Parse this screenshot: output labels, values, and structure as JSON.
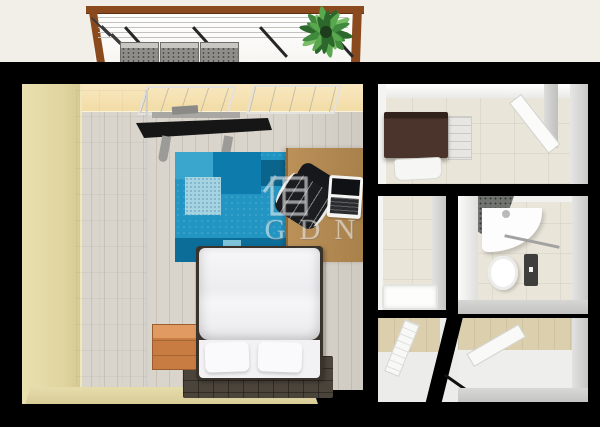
{
  "watermark": {
    "text": "GDN",
    "icon": "house-window-icon"
  },
  "palette": {
    "background": "#f2efe9",
    "wall": "#000000",
    "balcony_frame": "#8a4a1e",
    "bedroom_wall_top": "#f9e8c0",
    "bedroom_wall_side": "#e0d5a0",
    "bedroom_wall_bottom": "#d8cc98",
    "bedroom_floor": "#dad5cc",
    "rug_main": "#2295c3",
    "rug_dark": "#0d7cac",
    "rug_deep": "#0a648c",
    "rug_light": "#a6d3e1",
    "desk_wood": "#bb9159",
    "crate_wood": "#c97c42",
    "bed_rug": "#4b443b",
    "cabinet_dark": "#4b342b",
    "tile_floor": "#eae5d9",
    "wood_floor": "#dccfae",
    "plant_green": "#3f8a3c"
  }
}
